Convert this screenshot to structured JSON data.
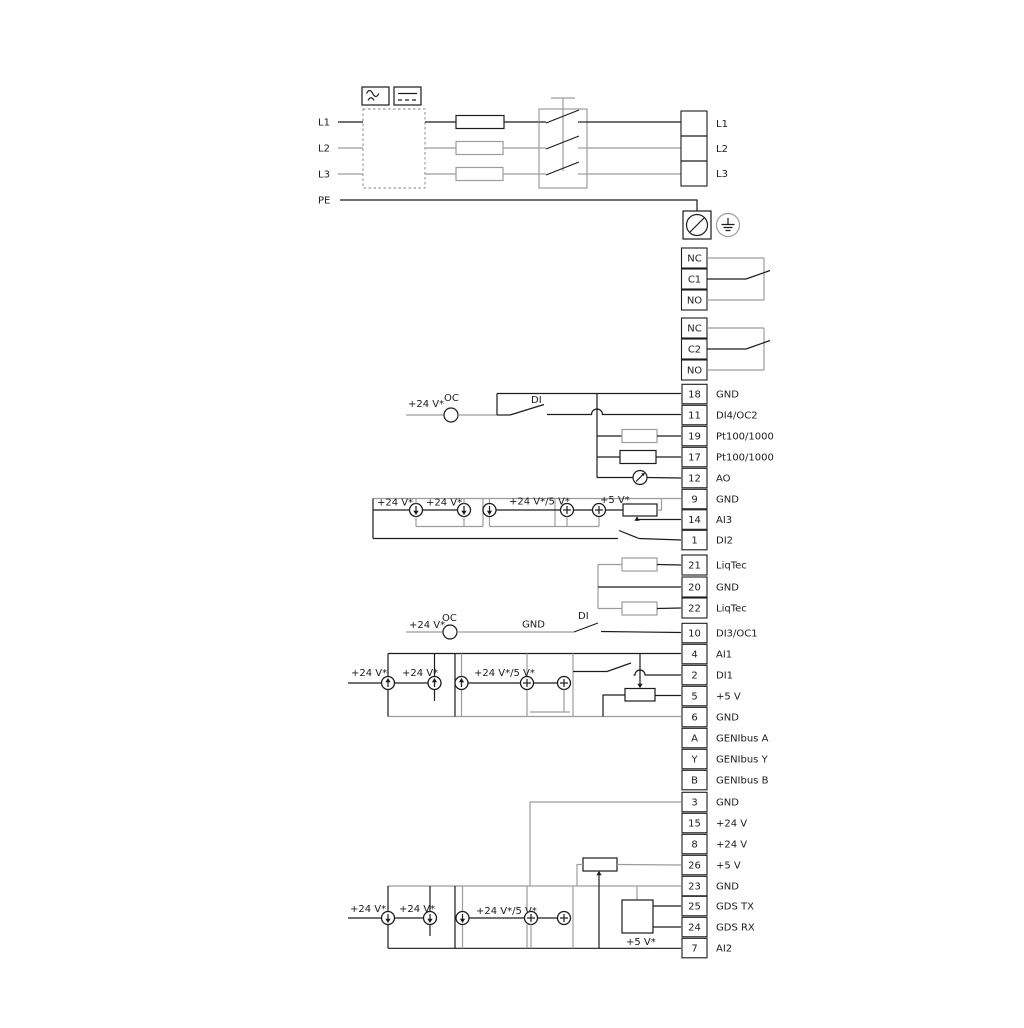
{
  "power": {
    "input_labels": [
      "L1",
      "L2",
      "L3",
      "PE"
    ],
    "output_labels": [
      "L1",
      "L2",
      "L3"
    ]
  },
  "relay1": {
    "terminals": [
      "NC",
      "C1",
      "NO"
    ]
  },
  "relay2": {
    "terminals": [
      "NC",
      "C2",
      "NO"
    ]
  },
  "io1": {
    "rows": [
      {
        "num": "18",
        "label": "GND"
      },
      {
        "num": "11",
        "label": "DI4/OC2"
      },
      {
        "num": "19",
        "label": "Pt100/1000"
      },
      {
        "num": "17",
        "label": "Pt100/1000"
      },
      {
        "num": "12",
        "label": "AO"
      },
      {
        "num": "9",
        "label": "GND"
      },
      {
        "num": "14",
        "label": "AI3"
      },
      {
        "num": "1",
        "label": "DI2"
      }
    ]
  },
  "liqtec": {
    "rows": [
      {
        "num": "21",
        "label": "LiqTec"
      },
      {
        "num": "20",
        "label": "GND"
      },
      {
        "num": "22",
        "label": "LiqTec"
      }
    ]
  },
  "io2": {
    "rows": [
      {
        "num": "10",
        "label": "DI3/OC1"
      },
      {
        "num": "4",
        "label": "AI1"
      },
      {
        "num": "2",
        "label": "DI1"
      },
      {
        "num": "5",
        "label": "+5 V"
      },
      {
        "num": "6",
        "label": "GND"
      },
      {
        "num": "A",
        "label": "GENIbus A"
      },
      {
        "num": "Y",
        "label": "GENIbus Y"
      },
      {
        "num": "B",
        "label": "GENIbus B"
      }
    ]
  },
  "io3": {
    "rows": [
      {
        "num": "3",
        "label": "GND"
      },
      {
        "num": "15",
        "label": "+24 V"
      },
      {
        "num": "8",
        "label": "+24 V"
      },
      {
        "num": "26",
        "label": "+5 V"
      },
      {
        "num": "23",
        "label": "GND"
      },
      {
        "num": "25",
        "label": "GDS TX"
      },
      {
        "num": "24",
        "label": "GDS RX"
      },
      {
        "num": "7",
        "label": "AI2"
      }
    ]
  },
  "labels": {
    "v24": "+24 V*",
    "v24v5": "+24 V*/5 V*",
    "v5": "+5 V*",
    "oc": "OC",
    "di": "DI",
    "gnd": "GND"
  },
  "colors": {
    "wire_gray": "#9c9c9c",
    "line_black": "#1c1c1c"
  }
}
